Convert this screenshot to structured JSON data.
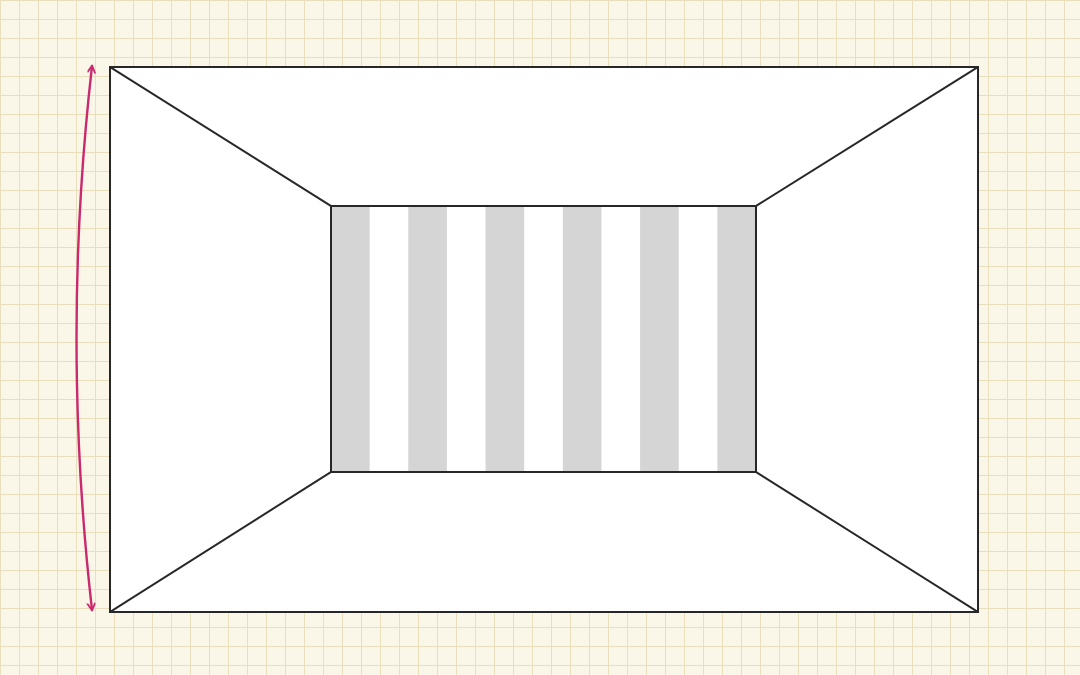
{
  "page": {
    "title": "perspective-room-illusion-diagram",
    "paper_background_color": "#fbf7e8",
    "grid_line_color": "#eadfbd",
    "grid_cell_size_px": 19
  },
  "diagram": {
    "description": "Perspective room with striped back wall and curved height arrow (size-constancy illusion)",
    "line_color": "#272727",
    "line_width": 2,
    "outer_rect": {
      "x": 110,
      "y": 67,
      "width": 868,
      "height": 545,
      "fill": "#ffffff"
    },
    "inner_rect": {
      "x": 331,
      "y": 206,
      "width": 425,
      "height": 266,
      "fill": "#ffffff"
    },
    "stripes": {
      "orientation": "vertical",
      "count": 11,
      "first_color": "#d5d5d5",
      "second_color": "#ffffff",
      "gray_band_count": 6,
      "white_band_count": 5
    },
    "diagonals": [
      {
        "x1": 110,
        "y1": 67,
        "x2": 331,
        "y2": 206
      },
      {
        "x1": 978,
        "y1": 67,
        "x2": 756,
        "y2": 206
      },
      {
        "x1": 110,
        "y1": 612,
        "x2": 331,
        "y2": 472
      },
      {
        "x1": 978,
        "y1": 612,
        "x2": 756,
        "y2": 472
      }
    ],
    "arrow": {
      "color": "#c92a6d",
      "stroke_width": 2.4,
      "top_tip": {
        "x": 92,
        "y": 66
      },
      "bottom_tip": {
        "x": 92,
        "y": 610
      },
      "control": {
        "x": 61,
        "y": 338
      },
      "double_headed": true
    }
  }
}
